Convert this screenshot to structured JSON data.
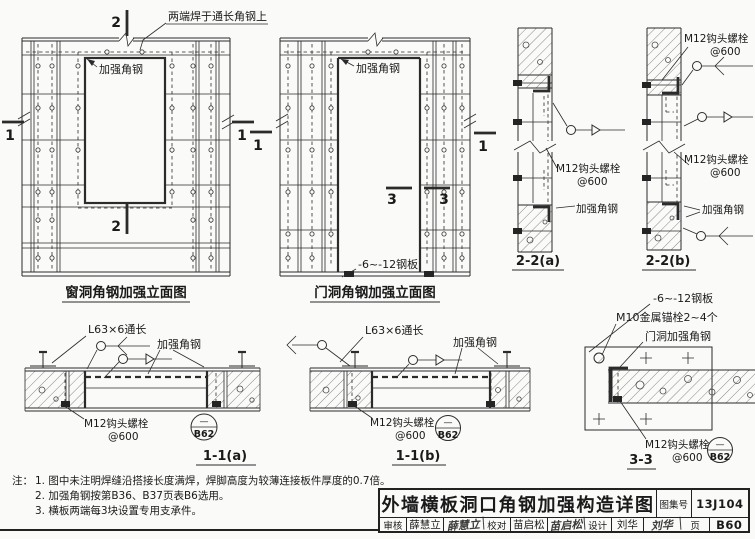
{
  "drawing": {
    "window_elevation": {
      "caption": "窗洞角钢加强立面图",
      "note_weld_top": "两端焊于通长角钢上",
      "label_angle": "加强角钢",
      "section_mark_2": "2",
      "section_mark_1": "1"
    },
    "door_elevation": {
      "caption": "门洞角钢加强立面图",
      "label_angle": "加强角钢",
      "label_plate": "-6~-12钢板",
      "section_mark_3": "3",
      "section_mark_1": "1"
    },
    "section_2_2a": {
      "caption": "2-2(a)",
      "bolt_line1": "M12钩头螺栓",
      "bolt_line2": "@600",
      "label_angle": "加强角钢"
    },
    "section_2_2b": {
      "caption": "2-2(b)",
      "bolt_top_line1": "M12钩头螺栓",
      "bolt_top_line2": "@600",
      "bolt_mid_line1": "M12钩头螺栓",
      "bolt_mid_line2": "@600",
      "label_angle": "加强角钢"
    },
    "section_1_1a": {
      "caption": "1-1(a)",
      "label_l63": "L63×6通长",
      "label_angle": "加强角钢",
      "bolt_line1": "M12钩头螺栓",
      "bolt_line2": "@600",
      "ref_detail": "—",
      "ref_page": "B62"
    },
    "section_1_1b": {
      "caption": "1-1(b)",
      "label_l63": "L63×6通长",
      "label_angle": "加强角钢",
      "bolt_line1": "M12钩头螺栓",
      "bolt_line2": "@600",
      "ref_detail": "—",
      "ref_page": "B62"
    },
    "section_3_3": {
      "caption": "3-3",
      "label_plate": "-6~-12钢板",
      "label_anchor": "M10金属锚栓2~4个",
      "label_door_angle": "门洞加强角钢",
      "bolt_line1": "M12钩头螺栓",
      "bolt_line2": "@600",
      "ref_detail": "—",
      "ref_page": "B62"
    }
  },
  "notes": {
    "prefix": "注：",
    "items": [
      "1. 图中未注明焊缝沿搭接长度满焊，焊脚高度为较薄连接板件厚度的0.7倍。",
      "2. 加强角钢按第B36、B37页表B6选用。",
      "3. 横板两端每3块设置专用支承件。"
    ]
  },
  "title_block": {
    "title": "外墙横板洞口角钢加强构造详图",
    "atlas_label": "图集号",
    "atlas_number": "13J104",
    "page_label": "页",
    "page_number": "B60",
    "reviewer_label": "审核",
    "reviewer_name": "薛慧立",
    "reviewer_signature": "薛慧立",
    "checker_label": "校对",
    "checker_name": "苗启松",
    "checker_signature": "苗启松",
    "designer_label": "设计",
    "designer_name": "刘华",
    "designer_signature": "刘华"
  },
  "colors": {
    "line": "#2b2b2b",
    "paper": "#fafaf8",
    "text": "#1a1a1a"
  }
}
